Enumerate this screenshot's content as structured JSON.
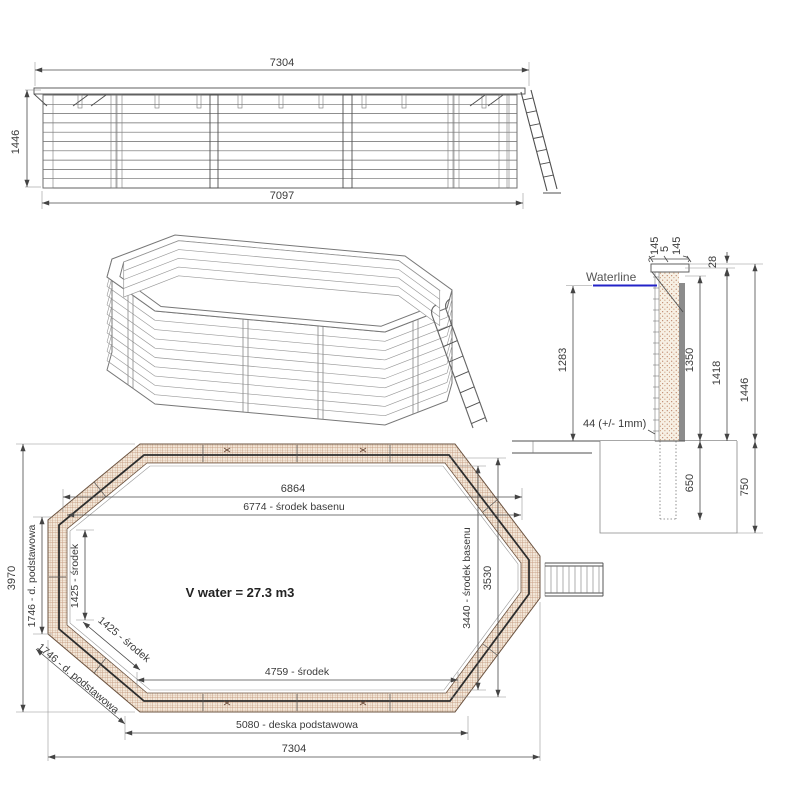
{
  "colors": {
    "waterline": "#2323c8",
    "hatch_brown": "#c49a7e",
    "band_fill": "#f2e7d9",
    "dot_brown": "#a85c3c",
    "dark_line": "#2d2d2d",
    "steel_gray": "#8c8c8c"
  },
  "elevation": {
    "dim_top": "7304",
    "dim_left": "1446",
    "dim_bottom": "7097"
  },
  "cross_section": {
    "cap_left": "145",
    "cap_gap": "5",
    "cap_right": "145",
    "cap_offset": "28",
    "waterline": "Waterline",
    "depth_water": "1283",
    "depth_inner": "1350",
    "height_wall": "1418",
    "height_total": "1446",
    "plank_note": "44 (+/- 1mm)",
    "buried": "650",
    "foundation": "750"
  },
  "plan": {
    "top_outer": "6864",
    "top_inner": "6774 - środek basenu",
    "volume": "V water = 27.3 m3",
    "height_total": "3970",
    "left_board": "1746 - d. podstawowa",
    "left_inner": "1425 - środek",
    "diag_inner": "1425 - środek",
    "diag_board": "1746 - d. podstawowa",
    "right_center": "3440 - środek basenu",
    "right_inner": "3530",
    "bottom_center": "4759 - środek",
    "bottom_board": "5080 - deska podstawowa",
    "bottom_outer": "7304"
  }
}
